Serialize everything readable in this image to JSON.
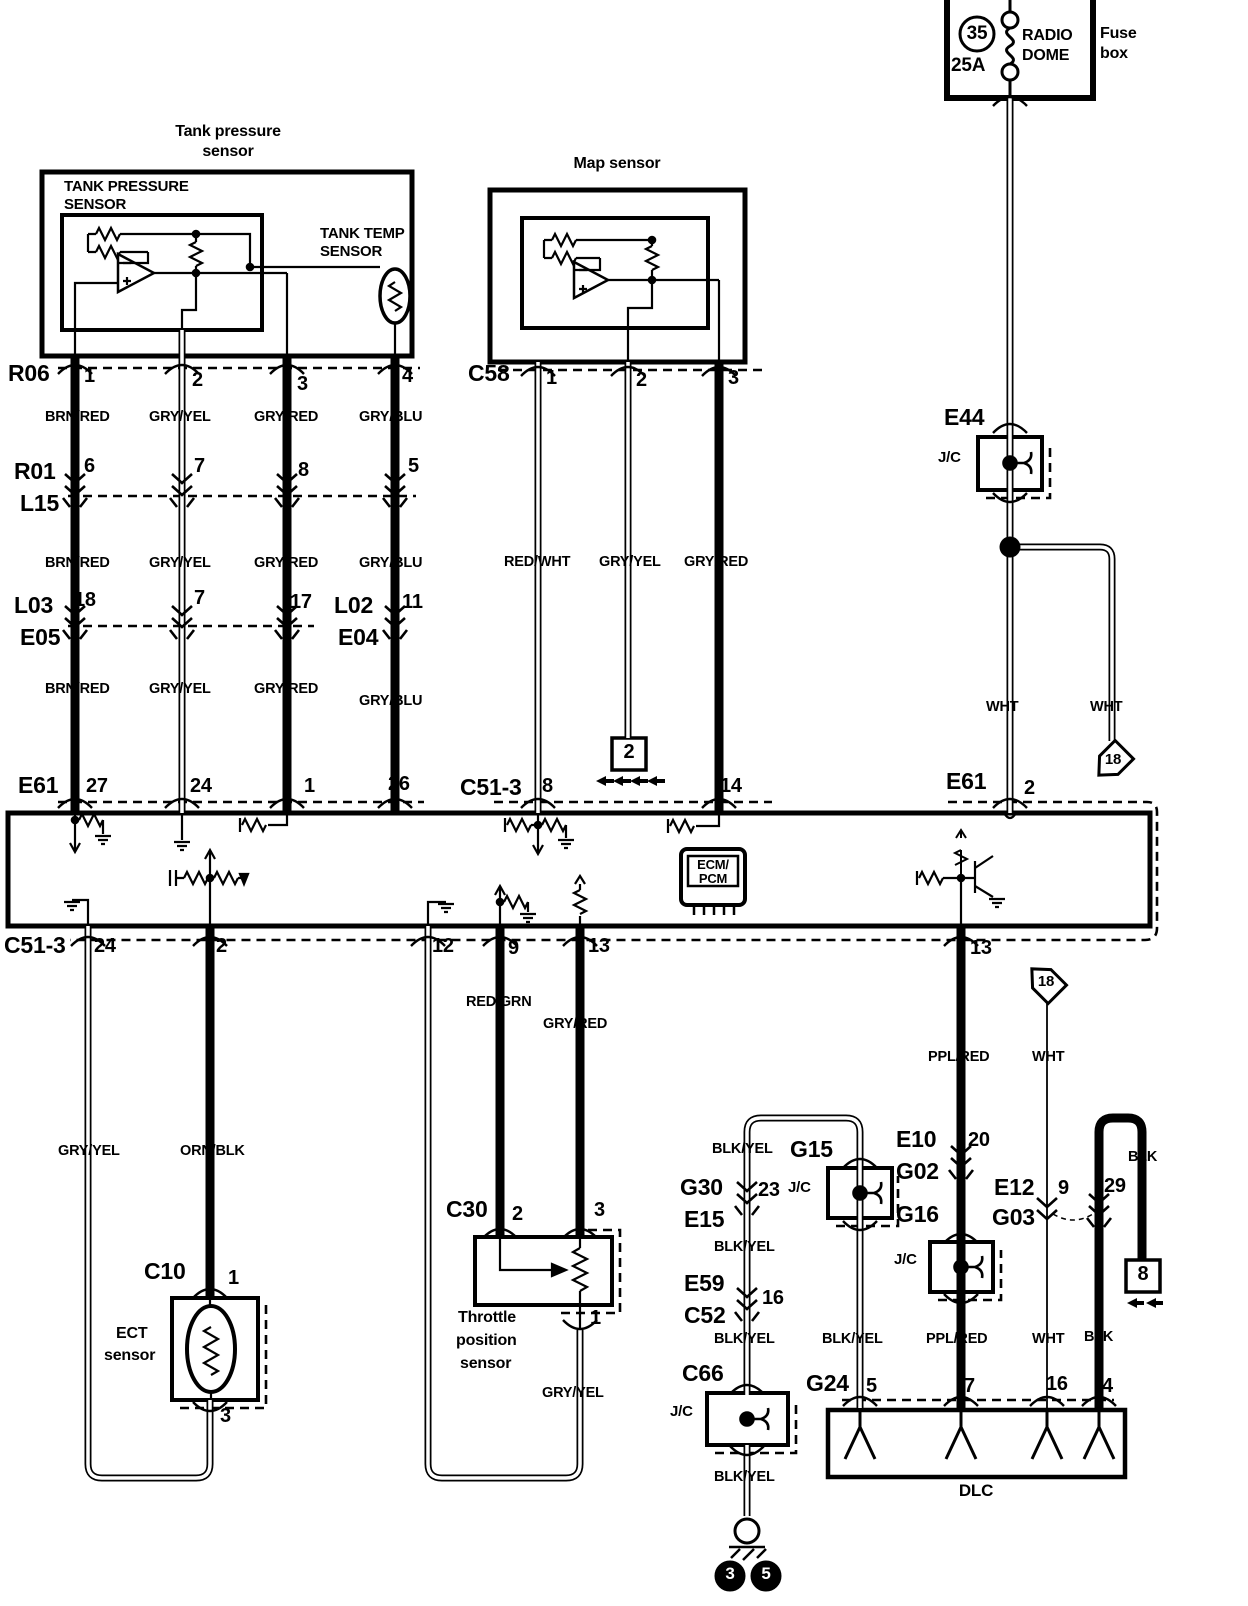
{
  "diagram_title": "Fuel / sensor wiring diagram (tank pressure, MAP, ECT, TPS, DLC)",
  "colors": {
    "line": "#000000",
    "background": "#ffffff",
    "label_on_dark": "#ffffff"
  },
  "sections": [
    {
      "name": "fuse-box",
      "labels": [
        {
          "id": "fuse-number",
          "t": "35",
          "x": 977,
          "y": 24,
          "fs": 19,
          "mid": 1
        },
        {
          "id": "fuse-rating",
          "t": "25A",
          "x": 951,
          "y": 56,
          "fs": 19
        },
        {
          "id": "fuse-name-line1",
          "t": "RADIO",
          "x": 1022,
          "y": 28,
          "fs": 16
        },
        {
          "id": "fuse-name-line2",
          "t": "DOME",
          "x": 1022,
          "y": 48,
          "fs": 16
        },
        {
          "id": "fuse-box-caption-line1",
          "t": "Fuse",
          "x": 1100,
          "y": 26,
          "fs": 16
        },
        {
          "id": "fuse-box-caption-line2",
          "t": "box",
          "x": 1100,
          "y": 46,
          "fs": 16
        }
      ]
    },
    {
      "name": "tank-pressure-sensor",
      "labels": [
        {
          "id": "tank-title-line1",
          "t": "Tank pressure",
          "x": 228,
          "y": 124,
          "fs": 16,
          "mid": 1
        },
        {
          "id": "tank-title-line2",
          "t": "sensor",
          "x": 228,
          "y": 144,
          "fs": 16,
          "mid": 1
        },
        {
          "id": "tank-inner-label-line1",
          "t": "TANK PRESSURE",
          "x": 64,
          "y": 179,
          "fs": 15
        },
        {
          "id": "tank-inner-label-line2",
          "t": "SENSOR",
          "x": 64,
          "y": 197,
          "fs": 15
        },
        {
          "id": "tank-temp-label-line1",
          "t": "TANK TEMP",
          "x": 320,
          "y": 226,
          "fs": 15
        },
        {
          "id": "tank-temp-label-line2",
          "t": "SENSOR",
          "x": 320,
          "y": 244,
          "fs": 15
        }
      ]
    },
    {
      "name": "map-sensor",
      "labels": [
        {
          "id": "map-title",
          "t": "Map sensor",
          "x": 617,
          "y": 156,
          "fs": 16,
          "mid": 1
        }
      ]
    },
    {
      "name": "connectors-top",
      "labels": [
        {
          "id": "conn-r06",
          "t": "R06",
          "x": 8,
          "y": 362,
          "fs": 23
        },
        {
          "id": "r06-pin-1",
          "t": "1",
          "x": 84,
          "y": 366,
          "fs": 20
        },
        {
          "id": "r06-pin-2",
          "t": "2",
          "x": 192,
          "y": 370,
          "fs": 20
        },
        {
          "id": "r06-pin-3",
          "t": "3",
          "x": 297,
          "y": 374,
          "fs": 20
        },
        {
          "id": "r06-pin-4",
          "t": "4",
          "x": 402,
          "y": 366,
          "fs": 20
        },
        {
          "id": "conn-r01",
          "t": "R01",
          "x": 14,
          "y": 460,
          "fs": 23
        },
        {
          "id": "conn-l15",
          "t": "L15",
          "x": 20,
          "y": 492,
          "fs": 23
        },
        {
          "id": "r01-pin-6",
          "t": "6",
          "x": 84,
          "y": 456,
          "fs": 20
        },
        {
          "id": "r01-pin-7",
          "t": "7",
          "x": 194,
          "y": 456,
          "fs": 20
        },
        {
          "id": "r01-pin-8",
          "t": "8",
          "x": 298,
          "y": 460,
          "fs": 20
        },
        {
          "id": "r01-pin-5",
          "t": "5",
          "x": 408,
          "y": 456,
          "fs": 20
        },
        {
          "id": "conn-l03",
          "t": "L03",
          "x": 14,
          "y": 594,
          "fs": 23
        },
        {
          "id": "conn-e05",
          "t": "E05",
          "x": 20,
          "y": 626,
          "fs": 23
        },
        {
          "id": "l03-pin-18",
          "t": "18",
          "x": 74,
          "y": 590,
          "fs": 20
        },
        {
          "id": "l03-pin-7",
          "t": "7",
          "x": 194,
          "y": 588,
          "fs": 20
        },
        {
          "id": "l03-pin-17",
          "t": "17",
          "x": 290,
          "y": 592,
          "fs": 20
        },
        {
          "id": "conn-l02",
          "t": "L02",
          "x": 334,
          "y": 594,
          "fs": 23
        },
        {
          "id": "conn-e04",
          "t": "E04",
          "x": 338,
          "y": 626,
          "fs": 23
        },
        {
          "id": "l02-pin-11",
          "t": "11",
          "x": 402,
          "y": 592,
          "fs": 20
        },
        {
          "id": "conn-c58",
          "t": "C58",
          "x": 468,
          "y": 362,
          "fs": 23
        },
        {
          "id": "c58-pin-1",
          "t": "1",
          "x": 546,
          "y": 368,
          "fs": 20
        },
        {
          "id": "c58-pin-2",
          "t": "2",
          "x": 636,
          "y": 370,
          "fs": 20
        },
        {
          "id": "c58-pin-3",
          "t": "3",
          "x": 728,
          "y": 368,
          "fs": 20
        },
        {
          "id": "conn-e61-left",
          "t": "E61",
          "x": 18,
          "y": 774,
          "fs": 23
        },
        {
          "id": "e61-pin-27",
          "t": "27",
          "x": 86,
          "y": 776,
          "fs": 20
        },
        {
          "id": "e61-pin-24",
          "t": "24",
          "x": 190,
          "y": 776,
          "fs": 20
        },
        {
          "id": "e61-pin-1",
          "t": "1",
          "x": 304,
          "y": 776,
          "fs": 20
        },
        {
          "id": "e61-pin-26",
          "t": "26",
          "x": 388,
          "y": 774,
          "fs": 20
        },
        {
          "id": "conn-c51-3-top",
          "t": "C51-3",
          "x": 460,
          "y": 776,
          "fs": 23
        },
        {
          "id": "c51-3-pin-8",
          "t": "8",
          "x": 542,
          "y": 776,
          "fs": 20
        },
        {
          "id": "c51-3-pin-14",
          "t": "14",
          "x": 720,
          "y": 776,
          "fs": 20
        },
        {
          "id": "conn-e61-right",
          "t": "E61",
          "x": 946,
          "y": 770,
          "fs": 23
        },
        {
          "id": "e61-pin-2",
          "t": "2",
          "x": 1024,
          "y": 778,
          "fs": 20
        },
        {
          "id": "conn-e44",
          "t": "E44",
          "x": 944,
          "y": 406,
          "fs": 23
        },
        {
          "id": "e44-jc-label",
          "t": "J/C",
          "x": 938,
          "y": 450,
          "fs": 15
        }
      ]
    },
    {
      "name": "wire-colors-top",
      "labels": [
        {
          "id": "wire-brnred-1",
          "t": "BRN/RED",
          "x": 45,
          "y": 410,
          "fs": 14.5
        },
        {
          "id": "wire-gryyel-1",
          "t": "GRY/YEL",
          "x": 149,
          "y": 410,
          "fs": 14.5
        },
        {
          "id": "wire-gryred-1",
          "t": "GRY/RED",
          "x": 254,
          "y": 410,
          "fs": 14.5
        },
        {
          "id": "wire-gryblu-1",
          "t": "GRY/BLU",
          "x": 359,
          "y": 410,
          "fs": 14.5
        },
        {
          "id": "wire-brnred-2",
          "t": "BRN/RED",
          "x": 45,
          "y": 556,
          "fs": 14.5
        },
        {
          "id": "wire-gryyel-2",
          "t": "GRY/YEL",
          "x": 149,
          "y": 556,
          "fs": 14.5
        },
        {
          "id": "wire-gryred-2",
          "t": "GRY/RED",
          "x": 254,
          "y": 556,
          "fs": 14.5
        },
        {
          "id": "wire-gryblu-2",
          "t": "GRY/BLU",
          "x": 359,
          "y": 556,
          "fs": 14.5
        },
        {
          "id": "wire-brnred-3",
          "t": "BRN/RED",
          "x": 45,
          "y": 682,
          "fs": 14.5
        },
        {
          "id": "wire-gryyel-3",
          "t": "GRY/YEL",
          "x": 149,
          "y": 682,
          "fs": 14.5
        },
        {
          "id": "wire-gryred-3",
          "t": "GRY/RED",
          "x": 254,
          "y": 682,
          "fs": 14.5
        },
        {
          "id": "wire-gryblu-3",
          "t": "GRY/BLU",
          "x": 359,
          "y": 694,
          "fs": 14.5
        },
        {
          "id": "wire-redwht",
          "t": "RED/WHT",
          "x": 504,
          "y": 555,
          "fs": 14.5
        },
        {
          "id": "wire-gryyel-map",
          "t": "GRY/YEL",
          "x": 599,
          "y": 555,
          "fs": 14.5
        },
        {
          "id": "wire-gryred-map",
          "t": "GRY/RED",
          "x": 684,
          "y": 555,
          "fs": 14.5
        },
        {
          "id": "wire-wht-left",
          "t": "WHT",
          "x": 986,
          "y": 700,
          "fs": 14.5
        },
        {
          "id": "wire-wht-right",
          "t": "WHT",
          "x": 1090,
          "y": 700,
          "fs": 14.5
        }
      ]
    },
    {
      "name": "ecm",
      "labels": [
        {
          "id": "ecm-label-line1",
          "t": "ECM/",
          "x": 713,
          "y": 858,
          "fs": 13,
          "mid": 1
        },
        {
          "id": "ecm-label-line2",
          "t": "PCM",
          "x": 713,
          "y": 872,
          "fs": 13,
          "mid": 1
        }
      ]
    },
    {
      "name": "connectors-bottom",
      "labels": [
        {
          "id": "conn-c51-3-bottom",
          "t": "C51-3",
          "x": 4,
          "y": 934,
          "fs": 23
        },
        {
          "id": "c51-3b-pin-24",
          "t": "24",
          "x": 94,
          "y": 936,
          "fs": 20
        },
        {
          "id": "c51-3b-pin-2",
          "t": "2",
          "x": 216,
          "y": 936,
          "fs": 20
        },
        {
          "id": "c51-3b-pin-12",
          "t": "12",
          "x": 432,
          "y": 936,
          "fs": 20
        },
        {
          "id": "c51-3b-pin-9",
          "t": "9",
          "x": 508,
          "y": 938,
          "fs": 20
        },
        {
          "id": "c51-3b-pin-13",
          "t": "13",
          "x": 588,
          "y": 936,
          "fs": 20
        },
        {
          "id": "c51-3b-pin-13-right",
          "t": "13",
          "x": 970,
          "y": 938,
          "fs": 20
        },
        {
          "id": "conn-c10",
          "t": "C10",
          "x": 144,
          "y": 1260,
          "fs": 23
        },
        {
          "id": "c10-pin-1",
          "t": "1",
          "x": 228,
          "y": 1268,
          "fs": 20
        },
        {
          "id": "c10-pin-3",
          "t": "3",
          "x": 220,
          "y": 1406,
          "fs": 20
        },
        {
          "id": "conn-c30",
          "t": "C30",
          "x": 446,
          "y": 1198,
          "fs": 23
        },
        {
          "id": "c30-pin-2",
          "t": "2",
          "x": 512,
          "y": 1204,
          "fs": 20
        },
        {
          "id": "c30-pin-3",
          "t": "3",
          "x": 594,
          "y": 1200,
          "fs": 20
        },
        {
          "id": "c30-pin-1",
          "t": "1",
          "x": 590,
          "y": 1308,
          "fs": 20
        },
        {
          "id": "conn-g30",
          "t": "G30",
          "x": 680,
          "y": 1176,
          "fs": 23
        },
        {
          "id": "conn-e15",
          "t": "E15",
          "x": 684,
          "y": 1208,
          "fs": 23
        },
        {
          "id": "g30-pin-23",
          "t": "23",
          "x": 758,
          "y": 1180,
          "fs": 20
        },
        {
          "id": "conn-e59",
          "t": "E59",
          "x": 684,
          "y": 1272,
          "fs": 23
        },
        {
          "id": "conn-c52",
          "t": "C52",
          "x": 684,
          "y": 1304,
          "fs": 23
        },
        {
          "id": "e59-pin-16",
          "t": "16",
          "x": 762,
          "y": 1288,
          "fs": 20
        },
        {
          "id": "conn-c66",
          "t": "C66",
          "x": 682,
          "y": 1362,
          "fs": 23
        },
        {
          "id": "c66-jc-label",
          "t": "J/C",
          "x": 670,
          "y": 1404,
          "fs": 15
        },
        {
          "id": "conn-g15",
          "t": "G15",
          "x": 790,
          "y": 1138,
          "fs": 23
        },
        {
          "id": "g15-jc-label",
          "t": "J/C",
          "x": 788,
          "y": 1180,
          "fs": 15
        },
        {
          "id": "conn-e10",
          "t": "E10",
          "x": 896,
          "y": 1128,
          "fs": 23
        },
        {
          "id": "conn-g02",
          "t": "G02",
          "x": 896,
          "y": 1160,
          "fs": 23
        },
        {
          "id": "e10-pin-20",
          "t": "20",
          "x": 968,
          "y": 1130,
          "fs": 20
        },
        {
          "id": "conn-g16",
          "t": "G16",
          "x": 896,
          "y": 1203,
          "fs": 23
        },
        {
          "id": "g16-jc-label",
          "t": "J/C",
          "x": 894,
          "y": 1252,
          "fs": 15
        },
        {
          "id": "conn-e12",
          "t": "E12",
          "x": 994,
          "y": 1176,
          "fs": 23
        },
        {
          "id": "conn-g03",
          "t": "G03",
          "x": 992,
          "y": 1206,
          "fs": 23
        },
        {
          "id": "e12-pin-9",
          "t": "9",
          "x": 1058,
          "y": 1178,
          "fs": 20
        },
        {
          "id": "e12-pin-29",
          "t": "29",
          "x": 1104,
          "y": 1176,
          "fs": 20
        },
        {
          "id": "conn-g24",
          "t": "G24",
          "x": 806,
          "y": 1372,
          "fs": 23
        },
        {
          "id": "g24-pin-5",
          "t": "5",
          "x": 866,
          "y": 1376,
          "fs": 20
        },
        {
          "id": "g24-pin-7",
          "t": "7",
          "x": 964,
          "y": 1376,
          "fs": 20
        },
        {
          "id": "g24-pin-16",
          "t": "16",
          "x": 1046,
          "y": 1374,
          "fs": 20
        },
        {
          "id": "g24-pin-4",
          "t": "4",
          "x": 1102,
          "y": 1376,
          "fs": 20
        }
      ]
    },
    {
      "name": "wire-colors-bottom",
      "labels": [
        {
          "id": "wire-gryyel-ect",
          "t": "GRY/YEL",
          "x": 58,
          "y": 1144,
          "fs": 14.5
        },
        {
          "id": "wire-ornblk",
          "t": "ORN/BLK",
          "x": 180,
          "y": 1144,
          "fs": 14.5
        },
        {
          "id": "wire-redgrn",
          "t": "RED/GRN",
          "x": 466,
          "y": 995,
          "fs": 14.5
        },
        {
          "id": "wire-gryred-tps",
          "t": "GRY/RED",
          "x": 543,
          "y": 1017,
          "fs": 14.5
        },
        {
          "id": "wire-pplred-1",
          "t": "PPL/RED",
          "x": 928,
          "y": 1050,
          "fs": 14.5
        },
        {
          "id": "wire-wht-dlc-1",
          "t": "WHT",
          "x": 1032,
          "y": 1050,
          "fs": 14.5
        },
        {
          "id": "wire-gryyel-tps",
          "t": "GRY/YEL",
          "x": 542,
          "y": 1386,
          "fs": 14.5
        },
        {
          "id": "wire-blkyel-a",
          "t": "BLK/YEL",
          "x": 712,
          "y": 1142,
          "fs": 14.5
        },
        {
          "id": "wire-blkyel-b",
          "t": "BLK/YEL",
          "x": 714,
          "y": 1240,
          "fs": 14.5
        },
        {
          "id": "wire-blkyel-c",
          "t": "BLK/YEL",
          "x": 714,
          "y": 1332,
          "fs": 14.5
        },
        {
          "id": "wire-blkyel-d",
          "t": "BLK/YEL",
          "x": 714,
          "y": 1470,
          "fs": 14.5
        },
        {
          "id": "wire-blk-right",
          "t": "BLK",
          "x": 1128,
          "y": 1150,
          "fs": 14.5
        },
        {
          "id": "wire-blkyel-g24",
          "t": "BLK/YEL",
          "x": 822,
          "y": 1332,
          "fs": 14.5
        },
        {
          "id": "wire-pplred-2",
          "t": "PPL/RED",
          "x": 926,
          "y": 1332,
          "fs": 14.5
        },
        {
          "id": "wire-wht-dlc-2",
          "t": "WHT",
          "x": 1032,
          "y": 1332,
          "fs": 14.5
        },
        {
          "id": "wire-blk-left",
          "t": "BLK",
          "x": 1084,
          "y": 1330,
          "fs": 14.5
        }
      ]
    },
    {
      "name": "devices",
      "labels": [
        {
          "id": "ect-label-line1",
          "t": "ECT",
          "x": 116,
          "y": 1326,
          "fs": 16
        },
        {
          "id": "ect-label-line2",
          "t": "sensor",
          "x": 104,
          "y": 1348,
          "fs": 16
        },
        {
          "id": "tps-label-line1",
          "t": "Throttle",
          "x": 458,
          "y": 1310,
          "fs": 16
        },
        {
          "id": "tps-label-line2",
          "t": "position",
          "x": 456,
          "y": 1333,
          "fs": 16
        },
        {
          "id": "tps-label-line3",
          "t": "sensor",
          "x": 460,
          "y": 1356,
          "fs": 16
        },
        {
          "id": "dlc-label",
          "t": "DLC",
          "x": 976,
          "y": 1482,
          "fs": 17,
          "mid": 1
        }
      ]
    },
    {
      "name": "reference-markers",
      "labels": [
        {
          "id": "offpage-ref-18-a",
          "t": "18",
          "x": 1113,
          "y": 752,
          "fs": 15,
          "mid": 1
        },
        {
          "id": "offpage-ref-18-b",
          "t": "18",
          "x": 1046,
          "y": 974,
          "fs": 15,
          "mid": 1
        },
        {
          "id": "offpage-ref-2",
          "t": "2",
          "x": 629,
          "y": 742,
          "fs": 20,
          "mid": 1
        },
        {
          "id": "offpage-ref-8",
          "t": "8",
          "x": 1143,
          "y": 1264,
          "fs": 20,
          "mid": 1
        },
        {
          "id": "ground-ref-3",
          "t": "3",
          "x": 730,
          "y": 1565,
          "fs": 17,
          "mid": 1,
          "color": "#ffffff"
        },
        {
          "id": "ground-ref-5",
          "t": "5",
          "x": 766,
          "y": 1565,
          "fs": 17,
          "mid": 1,
          "color": "#ffffff"
        }
      ]
    }
  ]
}
